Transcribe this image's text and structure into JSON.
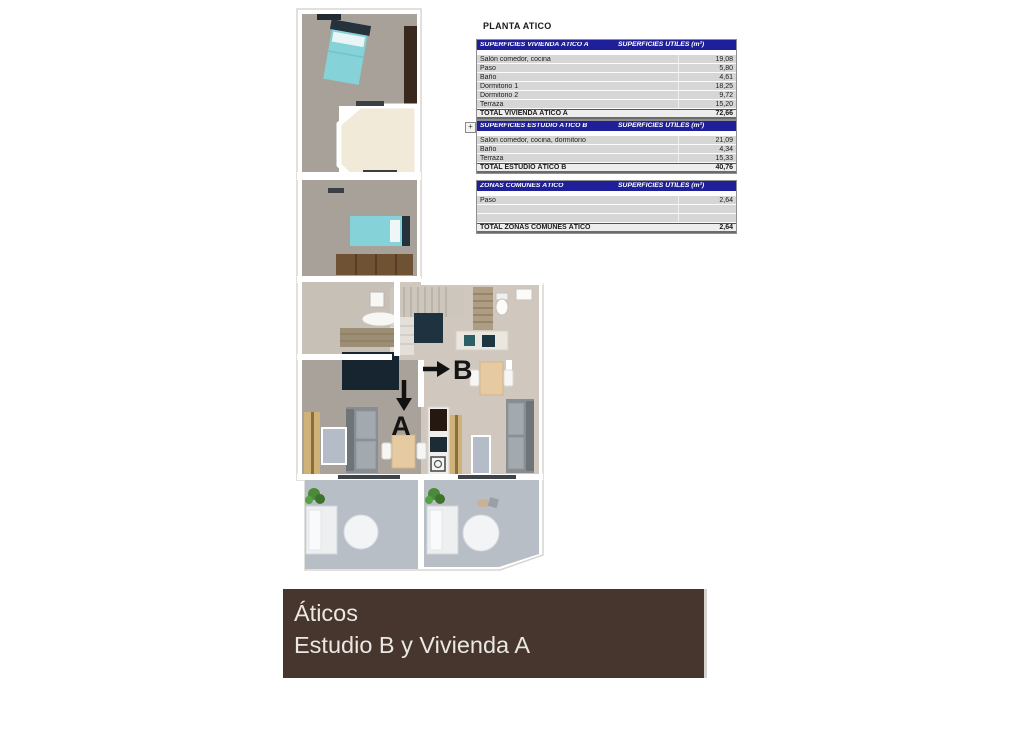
{
  "doc": {
    "title": "PLANTA ATICO",
    "outline_toggle": "+"
  },
  "tables": [
    {
      "header_left": "SUPERFICIES VIVIENDA ÁTICO A",
      "header_right": "SUPERFICIES UTILES  (m²)",
      "rows": [
        {
          "label": "Salón comedor, cocina",
          "value": "19,08"
        },
        {
          "label": "Paso",
          "value": "5,80"
        },
        {
          "label": "Baño",
          "value": "4,61"
        },
        {
          "label": "Dormitorio 1",
          "value": "18,25"
        },
        {
          "label": "Dormitorio 2",
          "value": "9,72"
        },
        {
          "label": "Terraza",
          "value": "15,20"
        }
      ],
      "total": {
        "label": "TOTAL VIVIENDA ÁTICO A",
        "value": "72,66"
      }
    },
    {
      "header_left": "SUPERFICIES ESTUDIO ÁTICO B",
      "header_right": "SUPERFICIES UTILES  (m²)",
      "rows": [
        {
          "label": "Salón comedor, cocina, dormitorio",
          "value": "21,09"
        },
        {
          "label": "Baño",
          "value": "4,34"
        },
        {
          "label": "Terraza",
          "value": "15,33"
        }
      ],
      "total": {
        "label": "TOTAL ESTUDIO ÁTICO B",
        "value": "40,76"
      }
    },
    {
      "header_left": "ZONAS COMUNES ÁTICO",
      "header_right": "SUPERFICIES UTILES  (m²)",
      "rows": [
        {
          "label": "Paso",
          "value": "2,64"
        },
        {
          "label": "",
          "value": ""
        },
        {
          "label": "",
          "value": ""
        }
      ],
      "total": {
        "label": "TOTAL ZONAS COMUNES ÁTICO",
        "value": "2,64"
      }
    }
  ],
  "plan": {
    "label_a": "A",
    "label_b": "B"
  },
  "banner": {
    "line1": "Áticos",
    "line2": "Estudio B y Vivienda A"
  },
  "colors": {
    "table_header_bg": "#1f1f99",
    "table_row_bg": "#d6d6d6",
    "banner_bg": "#46362e",
    "banner_text": "#ebe7e3",
    "bed_teal": "#86d2d9",
    "carpet_taupe": "#a8a19a",
    "terrace_cream": "#f2ead9",
    "terrace_gray": "#b7bec6",
    "furniture_navy": "#1e3240",
    "wood_brown": "#6f5134"
  }
}
